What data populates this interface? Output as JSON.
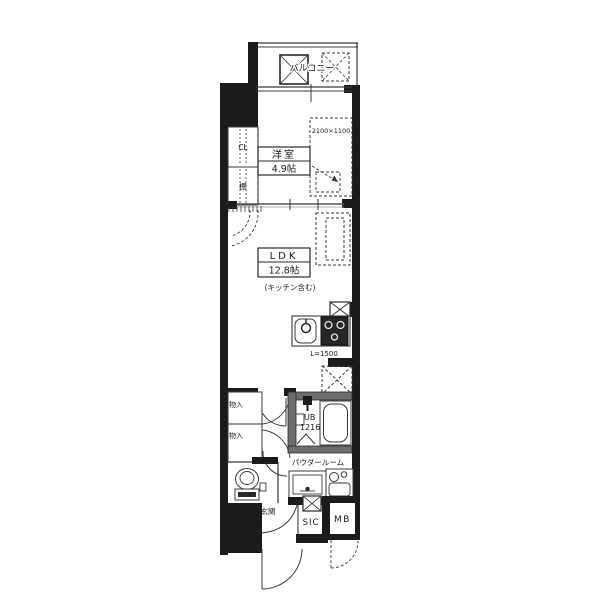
{
  "floorplan": {
    "labels": {
      "balcony": "バルコニー",
      "western_room": "洋室",
      "western_room_size": "4.9帖",
      "bed_dimensions": "2100×1100",
      "closet": "CL",
      "shelf": "棚",
      "ldk": "LDK",
      "ldk_size": "12.8帖",
      "ldk_note": "(キッチン含む)",
      "kitchen_counter_length": "L=1500",
      "unit_bath": "UB",
      "unit_bath_size": "1216",
      "powder_room": "パウダールーム",
      "storage_upper": "物入",
      "storage_lower": "物入",
      "entrance": "玄関",
      "shoe_in_closet": "SIC",
      "meter_box": "MB"
    },
    "colors": {
      "wall": "#1b1b1b",
      "inner_wall_gray": "#6e6e6e",
      "line": "#3a3a3a",
      "background": "#ffffff"
    }
  }
}
